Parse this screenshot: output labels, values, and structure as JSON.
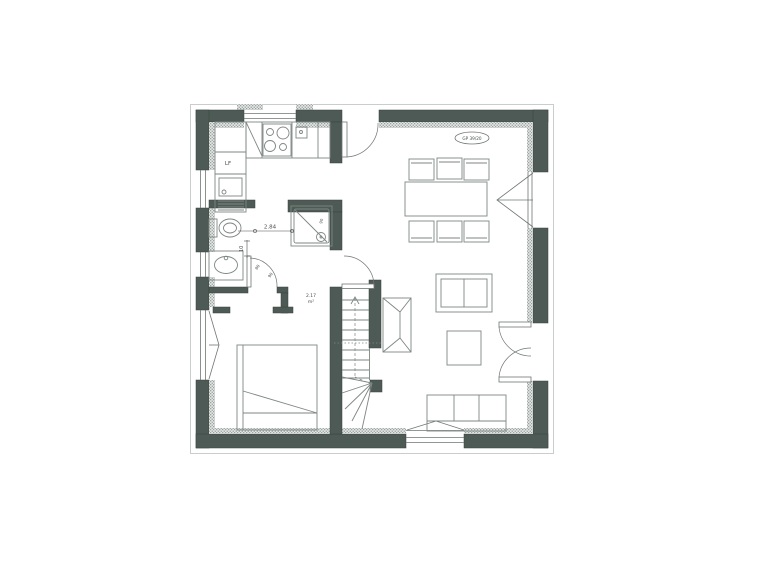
{
  "colors": {
    "wall": "#4e5a55",
    "wall_edge": "#39403d",
    "line": "#6e7672",
    "furniture": "#7d8682",
    "text": "#4a4f4d",
    "outer_outline": "#c9cecc",
    "hatch_bg": "#e4e7e6",
    "hatch_dot": "#9aa39f",
    "paper": "#ffffff"
  },
  "plan": {
    "stamp_text": "GP 39/20",
    "labels": {
      "room_width": "2.84",
      "wall_thickness": "10",
      "door_width_a": "80",
      "door_width_b": "90",
      "shower_size": "90",
      "appliance": "LF",
      "hall_area_value": "2.17",
      "hall_area_unit": "m²"
    }
  }
}
